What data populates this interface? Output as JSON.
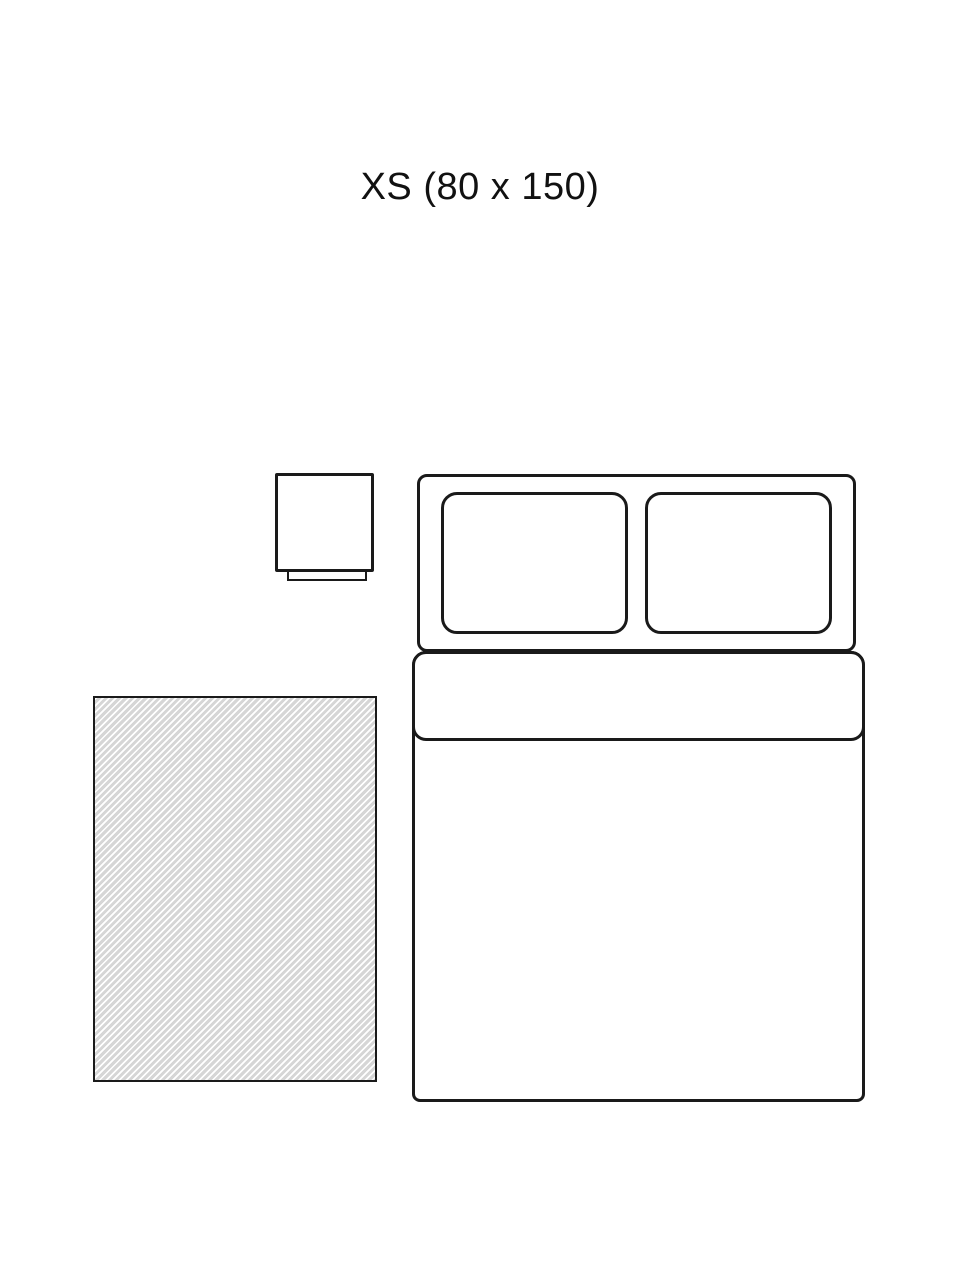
{
  "header": {
    "title": "XS (80 x 150)",
    "size_label": "XS",
    "rug_dimensions": "80 x 150"
  },
  "colors": {
    "stroke": "#1a1a1a",
    "rug-gray": "#d6d6d6",
    "rug-white": "#ffffff",
    "bg": "#ffffff",
    "text": "#111111"
  },
  "diagram": {
    "type": "rug-size-guide",
    "scene": "bedroom-top-view",
    "elements": [
      {
        "name": "nightstand-icon",
        "description": "square nightstand outline with base strip"
      },
      {
        "name": "bed-icon",
        "description": "double bed outline with headboard, two pillows, folded duvet, mattress"
      },
      {
        "name": "rug-icon",
        "description": "rug area shown as diagonal-hatched rectangle"
      }
    ]
  }
}
